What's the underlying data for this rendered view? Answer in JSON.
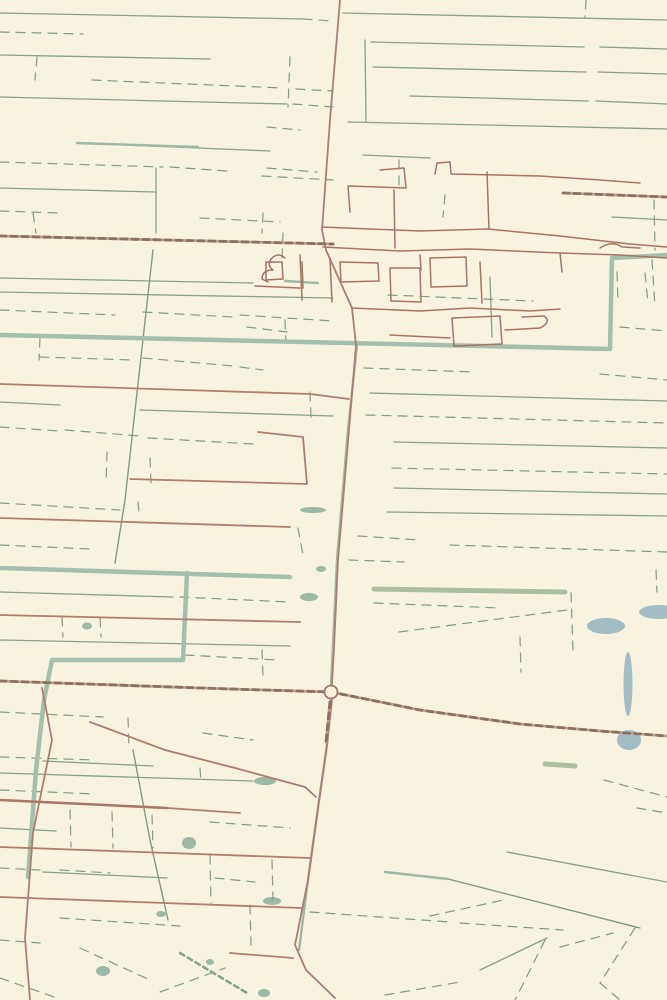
{
  "map": {
    "background": "#f8f2e1",
    "palette": {
      "parcel_line": "#87a28b",
      "parcel_dash": "#7e9e88",
      "canal": "#a4bfae",
      "canal_minor": "#9db8a7",
      "road": "#b07d6a",
      "road_major": "#ab7765",
      "village_road": "#a9745f",
      "railway_casing": "#bba48e",
      "railway_dash": "#8e7060",
      "green_area": "#cbcfa0",
      "green_patch": "#c6c9a7",
      "green_strip": "#a9bfa0",
      "pond": "#a3bdc5",
      "teal_water": "#9cb8a7"
    },
    "layers": [
      {
        "id": "green-areas",
        "kind": "fill",
        "color": "#cbcfa0",
        "paths": [
          "M374,587 L667,590 L667,766 L430,768 L420,750 L428,643 L400,633 L399,611 L374,604 Z",
          "M345,598 L374,600 L374,608 L345,605 Z"
        ]
      },
      {
        "id": "green-patches",
        "kind": "fill",
        "color": "#c6c9a7",
        "paths": [
          "M45,0 L180,0 L178,14 L44,12 Z",
          "M44,56 L90,57 L88,78 L42,79 Z",
          "M0,356 L35,357 L33,379 L0,378 Z",
          "M263,367 L310,368 L309,389 L262,388 Z"
        ]
      },
      {
        "id": "green-strips",
        "kind": "line",
        "color": "#a9bfa0",
        "width": 5,
        "paths": [
          "M374,589 L565,592",
          "M545,764 L575,766"
        ]
      },
      {
        "id": "ponds",
        "kind": "fill",
        "color": "#a3bdc5",
        "ellipses": [
          [
            606,
            626,
            19,
            8
          ],
          [
            659,
            612,
            20,
            7
          ],
          [
            628,
            684,
            4.5,
            32
          ],
          [
            629,
            740,
            12,
            10
          ]
        ]
      },
      {
        "id": "teal-waters",
        "kind": "fill",
        "color": "#9cb8a7",
        "ellipses": [
          [
            87,
            626,
            5,
            3.5
          ],
          [
            313,
            510,
            13,
            3
          ],
          [
            321,
            569,
            5,
            3
          ],
          [
            309,
            597,
            9,
            4
          ],
          [
            265,
            781,
            11,
            4
          ],
          [
            189,
            843,
            7,
            6
          ],
          [
            272,
            901,
            9,
            4
          ],
          [
            210,
            962,
            4,
            3
          ],
          [
            264,
            993,
            6,
            4
          ],
          [
            103,
            971,
            7,
            5
          ],
          [
            161,
            914,
            5,
            3
          ]
        ],
        "paths": [
          "M0,815 L20,817 L22,838 L8,840 L10,860 L22,862 L20,880 L0,878 Z",
          "M556,160 Q557,174 566,174 Q576,174 576,160 Z"
        ]
      },
      {
        "id": "parcel-lines",
        "kind": "line",
        "color": "#87a28b",
        "width": 1.3,
        "paths": [
          "M0,13 L303,19",
          "M0,55 L210,59",
          "M0,97 L287,104",
          "M77,143 L270,151",
          "M0,188 L155,192",
          "M156,168 L156,233",
          "M343,13 L667,20",
          "M371,42 L584,47 M600,47 L667,49",
          "M373,67 L586,72 M598,72 L667,74",
          "M410,96 L588,101 M596,101 L667,104",
          "M348,122 L667,129",
          "M363,155 L430,158",
          "M365,40 L366,122",
          "M612,217 L667,220",
          "M0,278 L253,283",
          "M0,292 L333,298",
          "M140,410 L333,416",
          "M0,402 L60,405",
          "M370,393 L667,401",
          "M394,442 L667,448",
          "M394,488 L667,494",
          "M387,512 L667,516",
          "M0,592 L173,597",
          "M0,640 L290,646",
          "M43,761 L153,766",
          "M0,773 L253,781",
          "M43,872 L167,878",
          "M0,828 L56,831",
          "M507,852 L667,882",
          "M480,970 L547,938",
          "M490,277 L492,337"
        ]
      },
      {
        "id": "watercourses",
        "kind": "line",
        "color": "#7f9c85",
        "width": 1.4,
        "paths": [
          "M153,250 L125,500 L115,563",
          "M133,750 L150,840 L168,920",
          "M448,879 L640,928"
        ]
      },
      {
        "id": "parcel-dashes",
        "kind": "line",
        "color": "#7e9e88",
        "width": 1.2,
        "dash": "9 7",
        "paths": [
          "M303,19 L333,21",
          "M0,32 L83,34",
          "M92,80 L283,88 M296,89 L333,91",
          "M293,104 L333,107",
          "M0,162 L163,167 M170,167 L227,171",
          "M267,127 L300,130",
          "M267,168 L317,172",
          "M37,57 L35,80",
          "M290,57 L288,107",
          "M33,213 L36,233",
          "M263,213 L262,233",
          "M200,218 L280,222",
          "M0,211 L60,213",
          "M586,0 L585,17",
          "M654,200 L655,250",
          "M262,176 L333,180",
          "M399,160 L399,185",
          "M283,233 L282,260",
          "M445,195 L443,217",
          "M388,295 L533,301",
          "M652,260 L655,307",
          "M364,368 L474,372",
          "M366,415 L667,423",
          "M392,468 L667,474",
          "M358,536 L420,540 M450,545 L667,552",
          "M349,560 L404,562",
          "M617,272 L618,303 M645,273 L648,303",
          "M620,327 L667,331",
          "M600,374 L667,380",
          "M520,637 L521,672",
          "M571,593 L573,652",
          "M656,570 L657,592",
          "M399,632 L567,610",
          "M374,603 L500,608",
          "M0,310 L115,315 M143,312 L233,317 M240,315 L333,321",
          "M247,327 L287,332",
          "M40,357 L133,360 M143,358 L233,366 M240,367 L263,370",
          "M40,338 L39,360",
          "M285,320 L286,343",
          "M310,392 L311,417",
          "M0,427 L60,431 M65,430 L140,436 M148,438 L253,444",
          "M107,452 L106,483 M150,458 L151,483",
          "M0,503 L120,510 M138,502 L139,512",
          "M298,528 L303,555",
          "M0,545 L90,549",
          "M180,597 L290,602",
          "M62,617 L63,637 M100,618 L101,637",
          "M185,655 L277,660",
          "M262,650 L263,677",
          "M0,712 L103,717",
          "M203,733 L253,740",
          "M128,718 L129,748",
          "M0,757 L95,760",
          "M200,768 L201,783",
          "M0,790 L95,794",
          "M70,810 L71,847 M112,812 L113,848 M152,815 L153,848",
          "M210,822 L290,828",
          "M0,868 L40,870 M60,870 L110,873",
          "M210,855 L211,903",
          "M215,878 L255,882",
          "M60,918 L180,926",
          "M0,940 L40,943",
          "M272,860 L273,900",
          "M250,905 L251,945",
          "M310,912 L450,922 M460,923 L563,930",
          "M545,940 L515,1000",
          "M635,928 L600,983 M600,983 L620,1000",
          "M560,947 L613,933",
          "M604,780 L667,797",
          "M637,808 L667,813",
          "M80,948 L150,980",
          "M0,978 L57,998",
          "M160,992 L225,968",
          "M385,995 L460,982",
          "M430,916 L508,899"
        ]
      },
      {
        "id": "canal-hatch",
        "kind": "line",
        "color": "#7fa38c",
        "width": 2.5,
        "dash": "5 4",
        "paths": [
          "M180,953 L247,993"
        ]
      },
      {
        "id": "canals",
        "kind": "line",
        "color": "#a4bfae",
        "width": 4.5,
        "paths": [
          "M0,335 L610,349 L612,258 L667,255",
          "M0,568 L290,577",
          "M187,573 L183,660 L52,660 L44,700 L36,770 L28,877"
        ]
      },
      {
        "id": "canal-minor",
        "kind": "line",
        "color": "#9db8a7",
        "width": 2.4,
        "paths": [
          "M77,143 L198,147",
          "M285,281 L318,283",
          "M385,872 L448,879",
          "M357,345 L348,430 L337,560 L333,645 L331,684",
          "M331,700 L327,745 L318,808 L308,880 L299,950"
        ]
      },
      {
        "id": "roads",
        "kind": "line",
        "color": "#b07d6a",
        "width": 1.8,
        "paths": [
          "M340,0 L330,120 L322,230 L326,250 L352,308 L356,345 L349,430 L338,560 L334,648 L332,684",
          "M332,700 L327,745 L318,808 L308,880 L295,945 L306,970 L335,998",
          "M0,384 L310,394 L349,399",
          "M258,432 L303,437 L307,484 L130,479",
          "M0,518 L290,527",
          "M0,615 L300,622",
          "M42,688 L52,740 L33,833 L25,938 L30,1000",
          "M90,722 L165,750 L235,768 L305,787 L316,797",
          "M167,808 L240,813",
          "M0,847 L310,858",
          "M0,897 L302,908",
          "M230,953 L293,958"
        ]
      },
      {
        "id": "roads-major",
        "kind": "line",
        "color": "#ab7765",
        "width": 2.6,
        "paths": [
          "M0,800 L167,808"
        ]
      },
      {
        "id": "village-roads",
        "kind": "line",
        "color": "#a9745f",
        "width": 1.5,
        "paths": [
          "M380,170 L404,168 L406,188 L348,186 L350,212",
          "M435,174 L437,163 L450,162 L451,174 L540,176 L600,180 L640,183",
          "M322,227 L420,231 L488,229 L560,236 L630,244 L667,247",
          "M487,172 L489,229",
          "M394,190 L395,248",
          "M323,247 L400,251 L470,249 L560,253 L620,255 L667,258",
          "M352,308 L420,311 L470,308 L530,311 L560,309",
          "M300,255 L302,300 M330,258 L332,302",
          "M340,262 L378,263 L379,281 L341,282 Z",
          "M390,268 L420,268 L421,302 L391,301 Z",
          "M430,258 L466,257 L467,286 L431,287 Z",
          "M480,262 L482,303",
          "M266,262 L282,262 L283,279 L266,280 Z",
          "M255,286 L300,288 M302,262 L303,288",
          "M560,253 L562,272",
          "M600,248 Q612,240 622,247 L640,248",
          "M452,318 L500,316 L502,344 L454,346 Z",
          "M390,335 L450,338 M505,330 L540,328 Q552,322 544,316 L522,317",
          "M285,258 Q278,252 272,258 Q266,265 273,270 Q262,270 262,279 L268,282",
          "M420,255 L421,270"
        ]
      },
      {
        "id": "railways",
        "kind": "railway",
        "casing": "#bba48e",
        "color": "#8e7060",
        "width": 2.8,
        "dash": "6 5",
        "paths": [
          "M0,236 L333,244",
          "M563,193 L667,197",
          "M0,681 L230,689 L331,692 L420,710 L520,724 L600,731 L667,736",
          "M330,702 L326,742"
        ]
      },
      {
        "id": "roundabouts",
        "kind": "circle",
        "color": "#a9745f",
        "width": 1.8,
        "circles": [
          [
            331,
            692,
            6.5
          ]
        ]
      }
    ]
  }
}
